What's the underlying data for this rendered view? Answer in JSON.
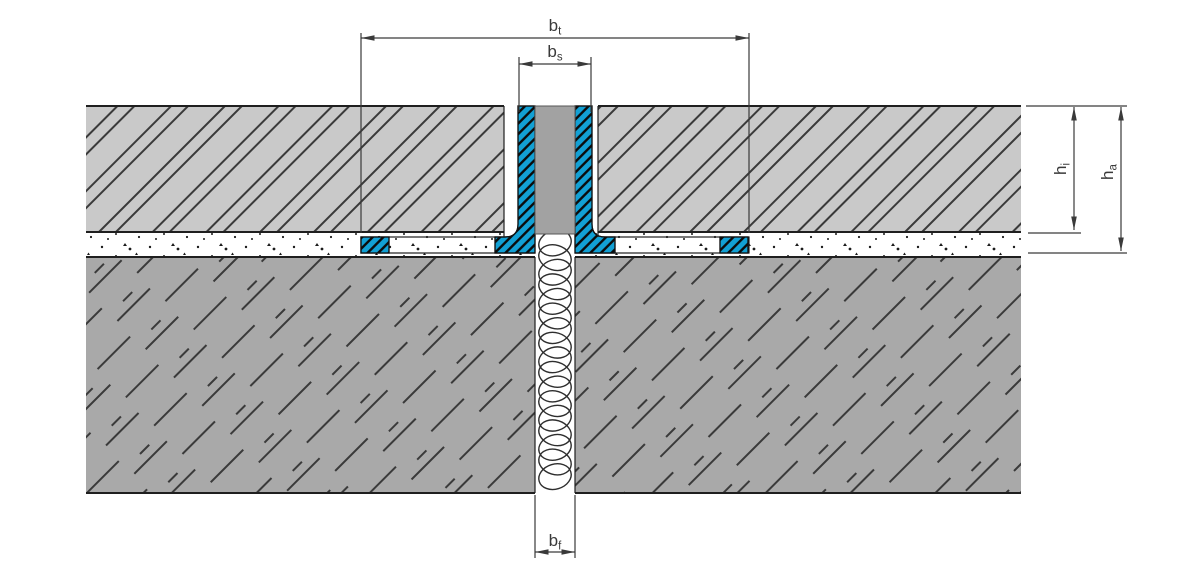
{
  "diagram": {
    "type": "technical-cross-section",
    "subject": "expansion-joint-profile-in-floor-assembly",
    "dimension_labels": {
      "bt": {
        "base": "b",
        "sub": "t"
      },
      "bs": {
        "base": "b",
        "sub": "s"
      },
      "hi": {
        "base": "h",
        "sub": "i"
      },
      "ha": {
        "base": "h",
        "sub": "a"
      },
      "bf": {
        "base": "b",
        "sub": "f"
      }
    },
    "colors": {
      "profile_blue": "#12a0d4",
      "screed_gray": "#c9c9c9",
      "concrete_gray": "#a9a9a9",
      "insert_gray": "#a2a2a2",
      "outline_dark": "#1f1f1f",
      "dimension_gray": "#3a3a3a",
      "hatch_line": "#3a3a3a"
    }
  }
}
